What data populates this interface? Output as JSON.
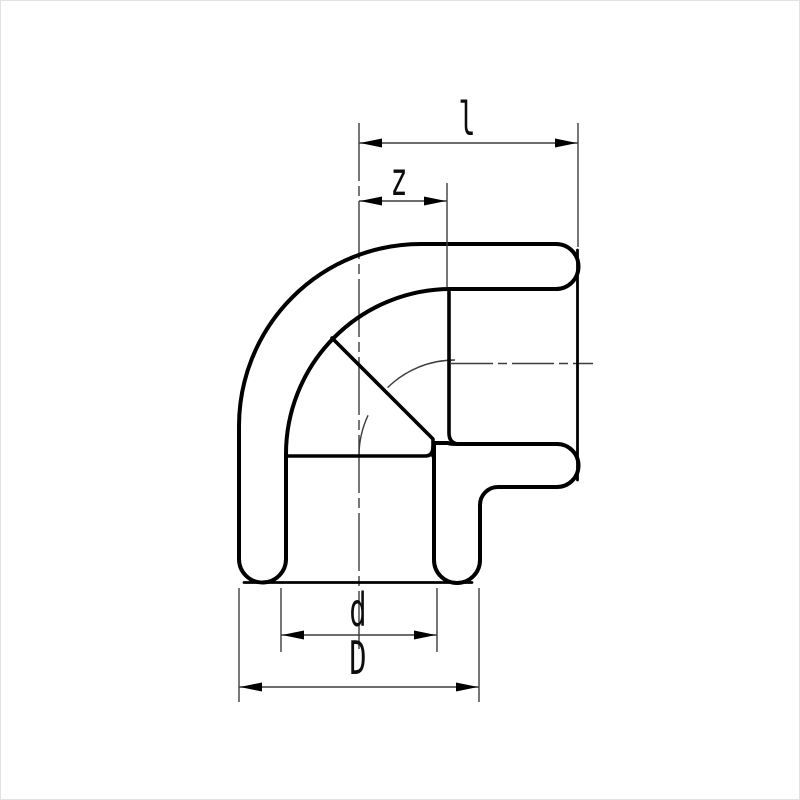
{
  "figure": {
    "kind": "technical-drawing",
    "subject": "90-degree socket elbow pipe fitting, sectional view with crosshatched walls",
    "dimensions": {
      "l": {
        "label": "l"
      },
      "z": {
        "label": "z"
      },
      "d": {
        "label": "d"
      },
      "D": {
        "label": "D"
      }
    },
    "colors": {
      "outline": "#000000",
      "dimension_lines": "#3d3d3d",
      "background": "#ffffff"
    }
  }
}
